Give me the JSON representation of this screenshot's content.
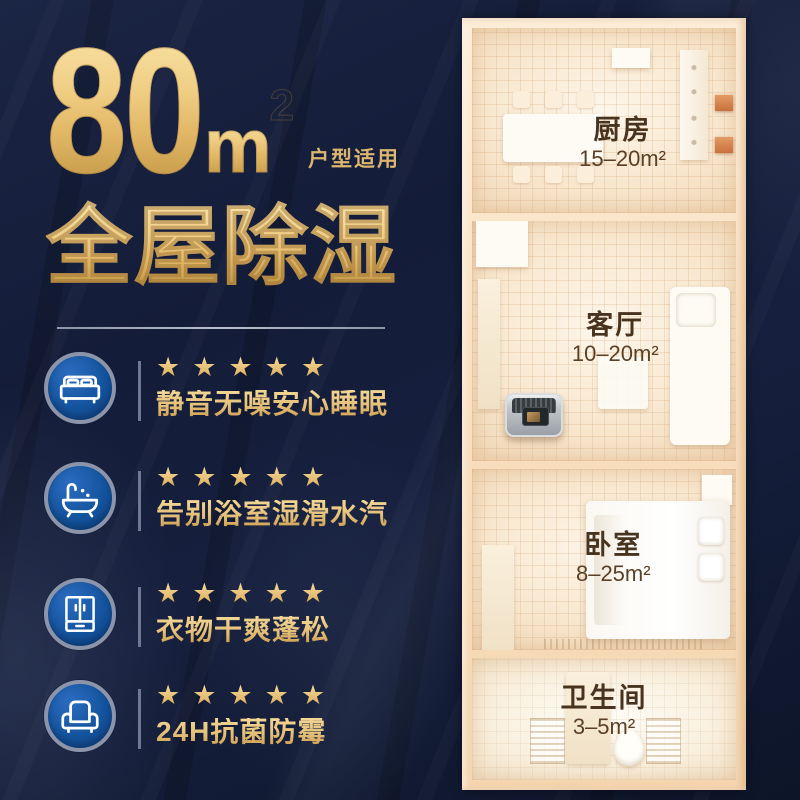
{
  "title": {
    "number": "80",
    "unit_m": "m",
    "unit_sup": "2",
    "suffix": "户型适用",
    "subtitle": "全屋除湿"
  },
  "features": [
    {
      "icon": "bed-icon",
      "stars": "★★★★★",
      "label": "静音无噪安心睡眠"
    },
    {
      "icon": "bathtub-icon",
      "stars": "★★★★★",
      "label": "告别浴室湿滑水汽"
    },
    {
      "icon": "wardrobe-icon",
      "stars": "★★★★★",
      "label": "衣物干爽蓬松"
    },
    {
      "icon": "sofa-icon",
      "stars": "★★★★★",
      "label": "24H抗菌防霉"
    }
  ],
  "floorplan": {
    "rooms": [
      {
        "name": "厨房",
        "area": "15–20m²"
      },
      {
        "name": "客厅",
        "area": "10–20m²"
      },
      {
        "name": "卧室",
        "area": "8–25m²"
      },
      {
        "name": "卫生间",
        "area": "3–5m²"
      }
    ]
  },
  "colors": {
    "background_navy": "#131c38",
    "gold_accent": "#e5c078",
    "icon_blue": "#14549f",
    "icon_ring_gray": "#8c94aa",
    "floor_peach": "#f9e9d2",
    "frame_cream": "#f9dfc0",
    "room_label_brown": "#48331f",
    "stove_orange": "#c9713c",
    "device_gray": "#9aa0a5"
  }
}
